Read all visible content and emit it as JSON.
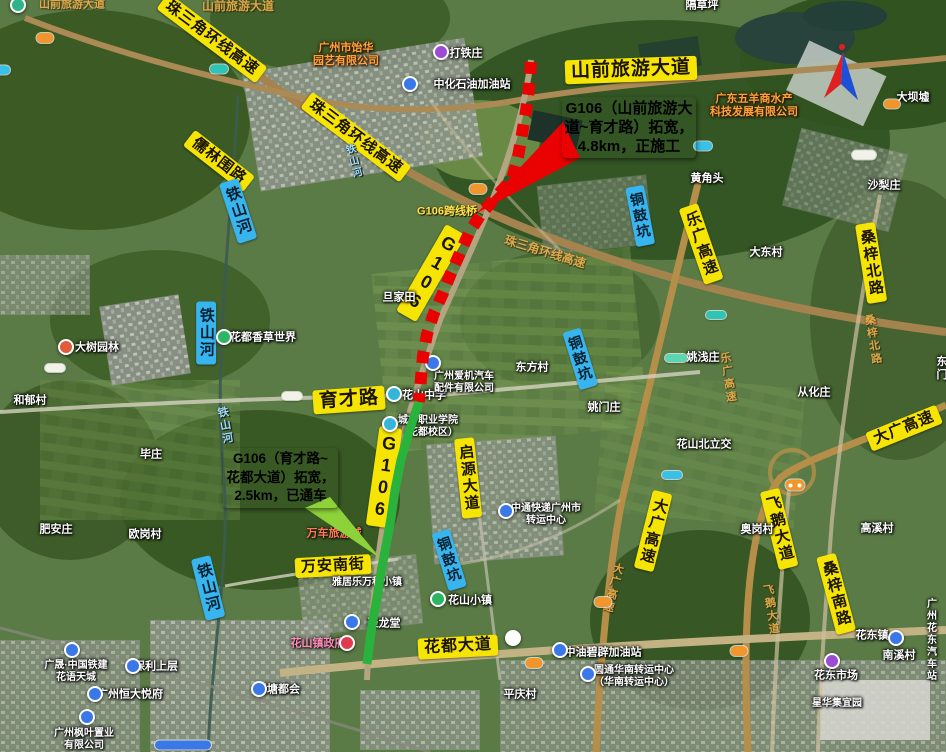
{
  "map_title": "G106拓宽工程示意图（卫星图）",
  "callouts": {
    "construction": {
      "line1": "G106（山前旅游大",
      "line2": "道~育才路）拓宽，",
      "line3": "4.8km，正施工",
      "bg": "#ea0202",
      "color": "#ffffff",
      "wedge_points": "563,122 580,158 477,213"
    },
    "opened": {
      "line1": "G106（育才路~",
      "line2": "花都大道）拓宽，",
      "line3": "2.5km，已通车",
      "bg": "#8ed23a",
      "color": "#e60000",
      "wedge_points": "305,508 330,497 380,558"
    }
  },
  "lines": {
    "construction": {
      "status": "正施工",
      "path": "M531,62 L529,88 L526,111 L522,134 L518,157 L512,179 L496,197 L481,214 L469,233 L460,253 L451,273 L443,293 L434,313 L427,334 L423,356 L421,378 L419,402",
      "color": "#ea0202",
      "width": 12,
      "dash": "12 9"
    },
    "opened": {
      "status": "已通车",
      "path": "M419,402 L409,432 L401,460 L395,490 L391,518 L386,546 L381,572 L377,598 L372,625 L369,648 L367,664",
      "color": "#2ab33c",
      "width": 9,
      "dash": "none"
    }
  },
  "road_labels": [
    {
      "t": "山前旅游大道",
      "cx": 631,
      "cy": 70,
      "rot": -2,
      "fs": 19,
      "cls": "yellow"
    },
    {
      "t": "珠三角环线高速",
      "cx": 212,
      "cy": 38,
      "rot": 37,
      "fs": 15,
      "cls": "yellow"
    },
    {
      "t": "珠三角环线高速",
      "cx": 356,
      "cy": 137,
      "rot": 37,
      "fs": 15,
      "cls": "yellow"
    },
    {
      "t": "儒林围路",
      "cx": 219,
      "cy": 161,
      "rot": 38,
      "fs": 15,
      "cls": "yellow"
    },
    {
      "t": "铁山河",
      "cx": 238,
      "cy": 211,
      "rot": -18,
      "fs": 15,
      "cls": "blue",
      "vert": true
    },
    {
      "t": "铁山河",
      "cx": 206,
      "cy": 333,
      "rot": 0,
      "fs": 15,
      "cls": "blue",
      "vert": true
    },
    {
      "t": "铁山河",
      "cx": 208,
      "cy": 588,
      "rot": -14,
      "fs": 15,
      "cls": "blue",
      "vert": true
    },
    {
      "t": "铜鼓坑",
      "cx": 640,
      "cy": 216,
      "rot": -11,
      "fs": 14,
      "cls": "blue",
      "vert": true
    },
    {
      "t": "铜鼓坑",
      "cx": 580,
      "cy": 359,
      "rot": -17,
      "fs": 14,
      "cls": "blue",
      "vert": true
    },
    {
      "t": "铜鼓坑",
      "cx": 449,
      "cy": 560,
      "rot": -17,
      "fs": 14,
      "cls": "blue",
      "vert": true
    },
    {
      "t": "G106",
      "cx": 431,
      "cy": 273,
      "rot": 30,
      "fs": 18,
      "cls": "yellow",
      "vert": true
    },
    {
      "t": "G106",
      "cx": 384,
      "cy": 477,
      "rot": 8,
      "fs": 18,
      "cls": "yellow",
      "vert": true
    },
    {
      "t": "育才路",
      "cx": 349,
      "cy": 400,
      "rot": -4,
      "fs": 19,
      "cls": "yellow"
    },
    {
      "t": "启源大道",
      "cx": 468,
      "cy": 478,
      "rot": -6,
      "fs": 15,
      "cls": "yellow",
      "vert": true
    },
    {
      "t": "万安南街",
      "cx": 333,
      "cy": 566,
      "rot": -3,
      "fs": 15,
      "cls": "yellow"
    },
    {
      "t": "花都大道",
      "cx": 458,
      "cy": 647,
      "rot": -3,
      "fs": 16,
      "cls": "yellow"
    },
    {
      "t": "乐广高速",
      "cx": 701,
      "cy": 244,
      "rot": -19,
      "fs": 15,
      "cls": "yellow",
      "vert": true
    },
    {
      "t": "桑梓北路",
      "cx": 871,
      "cy": 263,
      "rot": -9,
      "fs": 15,
      "cls": "yellow",
      "vert": true
    },
    {
      "t": "大广高速",
      "cx": 904,
      "cy": 428,
      "rot": -22,
      "fs": 15,
      "cls": "yellow"
    },
    {
      "t": "大广高速",
      "cx": 653,
      "cy": 531,
      "rot": 14,
      "fs": 15,
      "cls": "yellow",
      "vert": true
    },
    {
      "t": "飞鹅大道",
      "cx": 779,
      "cy": 529,
      "rot": -14,
      "fs": 15,
      "cls": "yellow",
      "vert": true
    },
    {
      "t": "桑梓南路",
      "cx": 836,
      "cy": 594,
      "rot": -15,
      "fs": 15,
      "cls": "yellow",
      "vert": true
    }
  ],
  "map_texts": [
    {
      "t": "山前旅游大道",
      "cx": 72,
      "cy": 5,
      "cls": "fadedroad",
      "fs": 11
    },
    {
      "t": "山前旅游大道",
      "cx": 238,
      "cy": 6,
      "cls": "fadedroad",
      "fs": 12
    },
    {
      "t": "打铁庄",
      "cx": 466,
      "cy": 54,
      "cls": "village"
    },
    {
      "t": "中化石油加油站",
      "cx": 472,
      "cy": 85,
      "cls": "village"
    },
    {
      "t": "隔草坪",
      "cx": 702,
      "cy": 6,
      "cls": "village"
    },
    {
      "t": "广州市饴华\n园艺有限公司",
      "cx": 346,
      "cy": 55,
      "cls": "company"
    },
    {
      "t": "广东五羊商水产\n科技发展有限公司",
      "cx": 754,
      "cy": 106,
      "cls": "company"
    },
    {
      "t": "大坝墟",
      "cx": 913,
      "cy": 98,
      "cls": "village"
    },
    {
      "t": "黄角头",
      "cx": 707,
      "cy": 179,
      "cls": "village"
    },
    {
      "t": "沙梨庄",
      "cx": 884,
      "cy": 186,
      "cls": "village"
    },
    {
      "t": "大东村",
      "cx": 766,
      "cy": 253,
      "cls": "village"
    },
    {
      "t": "G106跨线桥",
      "cx": 447,
      "cy": 212,
      "cls": "mapyellow"
    },
    {
      "t": "珠三角环线高速",
      "cx": 545,
      "cy": 252,
      "cls": "fadedroad",
      "rot": 17,
      "fs": 12
    },
    {
      "t": "铁山河",
      "cx": 352,
      "cy": 162,
      "cls": "water",
      "vert": true,
      "rot": -15,
      "fs": 10
    },
    {
      "t": "旦家田",
      "cx": 399,
      "cy": 298,
      "cls": "village"
    },
    {
      "t": "东方村",
      "cx": 532,
      "cy": 368,
      "cls": "village"
    },
    {
      "t": "姚浅庄",
      "cx": 703,
      "cy": 358,
      "cls": "village"
    },
    {
      "t": "从化庄",
      "cx": 814,
      "cy": 393,
      "cls": "village"
    },
    {
      "t": "东门",
      "cx": 942,
      "cy": 369,
      "cls": "village"
    },
    {
      "t": "和郁村",
      "cx": 30,
      "cy": 401,
      "cls": "village"
    },
    {
      "t": "大树园林",
      "cx": 97,
      "cy": 348,
      "cls": "village"
    },
    {
      "t": "花都香草世界",
      "cx": 263,
      "cy": 338,
      "cls": "village"
    },
    {
      "t": "铁山河",
      "cx": 224,
      "cy": 426,
      "cls": "water",
      "vert": true,
      "rot": -10,
      "fs": 11
    },
    {
      "t": "毕庄",
      "cx": 151,
      "cy": 455,
      "cls": "village"
    },
    {
      "t": "肥安庄",
      "cx": 56,
      "cy": 530,
      "cls": "village"
    },
    {
      "t": "欧岗村",
      "cx": 145,
      "cy": 535,
      "cls": "village"
    },
    {
      "t": "姚门庄",
      "cx": 604,
      "cy": 408,
      "cls": "village"
    },
    {
      "t": "花山中学",
      "cx": 424,
      "cy": 396,
      "cls": "village"
    },
    {
      "t": "城市职业学院\n（花都校区）",
      "cx": 428,
      "cy": 427,
      "cls": "village",
      "fs": 10
    },
    {
      "t": "广州爱机汽车\n配件有限公司",
      "cx": 464,
      "cy": 383,
      "cls": "village",
      "fs": 10
    },
    {
      "t": "花山北立交",
      "cx": 704,
      "cy": 445,
      "cls": "village"
    },
    {
      "t": "奥岗村",
      "cx": 757,
      "cy": 530,
      "cls": "village"
    },
    {
      "t": "高溪村",
      "cx": 877,
      "cy": 529,
      "cls": "village"
    },
    {
      "t": "乐广高速",
      "cx": 727,
      "cy": 378,
      "cls": "fadedroad",
      "vert": true,
      "rot": -8,
      "fs": 11
    },
    {
      "t": "桑梓北路",
      "cx": 872,
      "cy": 340,
      "cls": "fadedroad",
      "vert": true,
      "rot": -9,
      "fs": 11
    },
    {
      "t": "大广高速",
      "cx": 612,
      "cy": 588,
      "cls": "fadedroad",
      "vert": true,
      "rot": 14,
      "fs": 11
    },
    {
      "t": "飞鹅大道",
      "cx": 770,
      "cy": 610,
      "cls": "fadedroad",
      "vert": true,
      "rot": -8,
      "fs": 11
    },
    {
      "t": "中通快递广州市\n转运中心",
      "cx": 546,
      "cy": 515,
      "cls": "village",
      "fs": 10
    },
    {
      "t": "万车旅游城",
      "cx": 334,
      "cy": 534,
      "cls": "redtext",
      "fs": 11
    },
    {
      "t": "雅居乐万科小镇",
      "cx": 367,
      "cy": 583,
      "cls": "village",
      "fs": 10
    },
    {
      "t": "聚龙堂",
      "cx": 384,
      "cy": 624,
      "cls": "village"
    },
    {
      "t": "花山小镇",
      "cx": 470,
      "cy": 601,
      "cls": "village"
    },
    {
      "t": "花山镇政府",
      "cx": 318,
      "cy": 644,
      "cls": "pink"
    },
    {
      "t": "平庆村",
      "cx": 520,
      "cy": 695,
      "cls": "village"
    },
    {
      "t": "中油碧辟加油站",
      "cx": 603,
      "cy": 653,
      "cls": "village"
    },
    {
      "t": "圆通华南转运中心\n（华南转运中心）",
      "cx": 634,
      "cy": 677,
      "cls": "village",
      "fs": 10
    },
    {
      "t": "花东镇",
      "cx": 872,
      "cy": 636,
      "cls": "village"
    },
    {
      "t": "广州花东汽车站",
      "cx": 932,
      "cy": 641,
      "cls": "village",
      "fs": 10
    },
    {
      "t": "南溪村",
      "cx": 899,
      "cy": 656,
      "cls": "village"
    },
    {
      "t": "花东市场",
      "cx": 836,
      "cy": 676,
      "cls": "village"
    },
    {
      "t": "星华集宜园",
      "cx": 837,
      "cy": 704,
      "cls": "village",
      "fs": 10
    },
    {
      "t": "新塘都会",
      "cx": 278,
      "cy": 690,
      "cls": "village"
    },
    {
      "t": "保利上层",
      "cx": 156,
      "cy": 667,
      "cls": "village"
    },
    {
      "t": "广晟·中国铁建\n花语天城",
      "cx": 76,
      "cy": 672,
      "cls": "village",
      "fs": 10
    },
    {
      "t": "广州恒大悦府",
      "cx": 130,
      "cy": 695,
      "cls": "village"
    },
    {
      "t": "广州枫叶置业\n有限公司",
      "cx": 84,
      "cy": 740,
      "cls": "village",
      "fs": 10
    }
  ],
  "markers": [
    {
      "cx": 441,
      "cy": 52,
      "c": "#9c4bd4"
    },
    {
      "cx": 410,
      "cy": 84,
      "c": "#3a78e8"
    },
    {
      "cx": 18,
      "cy": 5,
      "c": "#2db487"
    },
    {
      "cx": 66,
      "cy": 347,
      "c": "#e05a3c"
    },
    {
      "cx": 224,
      "cy": 337,
      "c": "#2db464"
    },
    {
      "cx": 433,
      "cy": 363,
      "c": "#3a78e8"
    },
    {
      "cx": 394,
      "cy": 394,
      "c": "#35b5d8"
    },
    {
      "cx": 390,
      "cy": 424,
      "c": "#35b5d8"
    },
    {
      "cx": 506,
      "cy": 511,
      "c": "#3a78e8"
    },
    {
      "cx": 352,
      "cy": 622,
      "c": "#3a78e8"
    },
    {
      "cx": 438,
      "cy": 599,
      "c": "#2db464"
    },
    {
      "cx": 347,
      "cy": 643,
      "c": "#e03a50"
    },
    {
      "cx": 560,
      "cy": 650,
      "c": "#3a78e8"
    },
    {
      "cx": 588,
      "cy": 674,
      "c": "#3a78e8"
    },
    {
      "cx": 896,
      "cy": 638,
      "c": "#3a78e8"
    },
    {
      "cx": 832,
      "cy": 661,
      "c": "#9c4bd4"
    },
    {
      "cx": 259,
      "cy": 689,
      "c": "#3a78e8"
    },
    {
      "cx": 133,
      "cy": 666,
      "c": "#3a78e8"
    },
    {
      "cx": 72,
      "cy": 650,
      "c": "#3a78e8"
    },
    {
      "cx": 95,
      "cy": 694,
      "c": "#3a78e8"
    },
    {
      "cx": 87,
      "cy": 717,
      "c": "#3a78e8"
    },
    {
      "cx": 513,
      "cy": 638,
      "c": "#ffffff"
    }
  ],
  "shields": [
    {
      "cx": 45,
      "cy": 38,
      "w": 17,
      "h": 10,
      "c": "#f0962c"
    },
    {
      "cx": 3,
      "cy": 70,
      "w": 14,
      "h": 9,
      "c": "#39c0e8"
    },
    {
      "cx": 219,
      "cy": 69,
      "w": 18,
      "h": 9,
      "c": "#2ec4b6"
    },
    {
      "cx": 703,
      "cy": 146,
      "w": 18,
      "h": 9,
      "c": "#39c0e8"
    },
    {
      "cx": 478,
      "cy": 189,
      "w": 17,
      "h": 10,
      "c": "#f0962c"
    },
    {
      "cx": 892,
      "cy": 104,
      "w": 16,
      "h": 9,
      "c": "#f0962c"
    },
    {
      "cx": 864,
      "cy": 155,
      "w": 24,
      "h": 9,
      "c": "#f2f2ea"
    },
    {
      "cx": 716,
      "cy": 315,
      "w": 20,
      "h": 8,
      "c": "#2ec4b6"
    },
    {
      "cx": 55,
      "cy": 368,
      "w": 20,
      "h": 8,
      "c": "#f2f2ea"
    },
    {
      "cx": 292,
      "cy": 396,
      "w": 20,
      "h": 8,
      "c": "#f2f2ea"
    },
    {
      "cx": 676,
      "cy": 358,
      "w": 22,
      "h": 8,
      "c": "#5bd6b0"
    },
    {
      "cx": 672,
      "cy": 475,
      "w": 20,
      "h": 8,
      "c": "#39c0e8"
    },
    {
      "cx": 795,
      "cy": 485,
      "w": 19,
      "h": 11,
      "c": "#f0962c",
      "dots": true
    },
    {
      "cx": 603,
      "cy": 602,
      "w": 17,
      "h": 10,
      "c": "#f0962c"
    },
    {
      "cx": 534,
      "cy": 663,
      "w": 17,
      "h": 10,
      "c": "#f0962c"
    },
    {
      "cx": 739,
      "cy": 651,
      "w": 17,
      "h": 10,
      "c": "#f0962c"
    },
    {
      "cx": 183,
      "cy": 745,
      "w": 56,
      "h": 9,
      "c": "#3a78e8"
    }
  ],
  "compass": {
    "red": "#e02020",
    "blue": "#1d4fd7"
  }
}
